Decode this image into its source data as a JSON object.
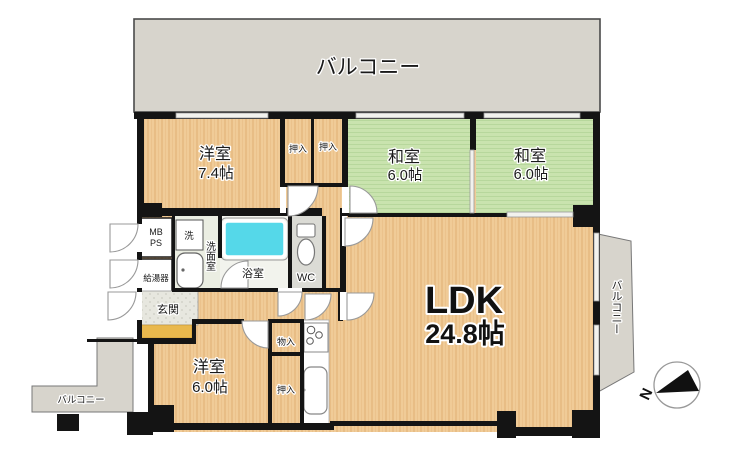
{
  "plan": {
    "balcony_top": "バルコニー",
    "balcony_right": "バルコニー",
    "balcony_bottom_left": "バルコニー",
    "western_room_1": {
      "name": "洋室",
      "size": "7.4帖"
    },
    "japanese_room_1": {
      "name": "和室",
      "size": "6.0帖"
    },
    "japanese_room_2": {
      "name": "和室",
      "size": "6.0帖"
    },
    "western_room_2": {
      "name": "洋室",
      "size": "6.0帖"
    },
    "ldk": {
      "name": "LDK",
      "size": "24.8帖"
    },
    "closet_top_1": "押入",
    "closet_top_2": "押入",
    "closet_bottom": "押入",
    "storage": "物入",
    "meter_box": "MB",
    "pipe_space": "PS",
    "washer": "洗",
    "washroom": "洗面室",
    "water_heater": "給湯器",
    "bathroom": "浴室",
    "toilet": "WC",
    "entrance": "玄関",
    "compass_north": "N"
  },
  "colors": {
    "wood": "#F0CB97",
    "wood_grain": "#E8BD85",
    "tatami": "#C9E3AE",
    "tatami_line": "#B7D79C",
    "balcony": "#D7D4CC",
    "wall": "#141414",
    "bathtub": "#55D8E9",
    "entrance_step": "#E9B84D"
  }
}
